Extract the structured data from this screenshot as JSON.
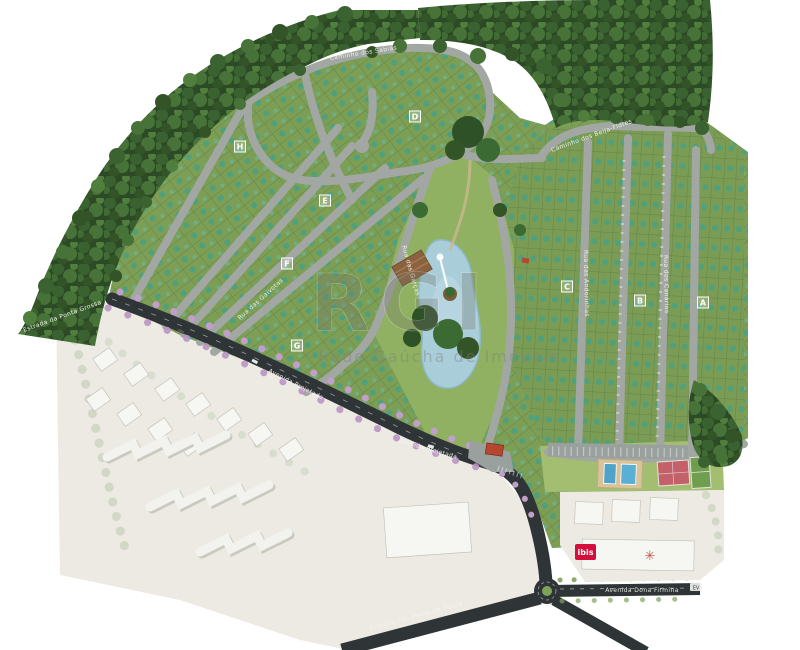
{
  "map": {
    "watermark": {
      "mark": "RGI",
      "text": "Rede Gaúcha de Imóveis"
    },
    "blocks": [
      {
        "label": "A"
      },
      {
        "label": "B"
      },
      {
        "label": "C"
      },
      {
        "label": "D"
      },
      {
        "label": "E"
      },
      {
        "label": "F"
      },
      {
        "label": "G"
      },
      {
        "label": "H"
      }
    ],
    "streets": [
      {
        "name": "Caminho dos Sabiás"
      },
      {
        "name": "Caminho dos Beija-Flores"
      },
      {
        "name": "Rua das Garças"
      },
      {
        "name": "Rua das Gaivotas"
      },
      {
        "name": "Rua das Andorinhas"
      },
      {
        "name": "Rua dos Canários"
      },
      {
        "name": "Avenida Projetada"
      },
      {
        "name": "Avenida Projetada"
      },
      {
        "name": "Avenida Dona Firmina"
      },
      {
        "name": "Avenida Cel. Pedro de Souza"
      },
      {
        "name": "Estrada da Ponta Grossa"
      }
    ],
    "tags": {
      "ev": "EV",
      "hotel": "ibis"
    },
    "colors": {
      "forest": "#2d4a27",
      "grass": "#7c9e55",
      "park": "#8fb161",
      "road": "#a3a7a3",
      "avenue": "#2f3537",
      "lake": "#a9cdd9",
      "pink_trees": "#c29fc9",
      "accent_red": "#c41e3a",
      "faded": "#eceae3"
    }
  }
}
